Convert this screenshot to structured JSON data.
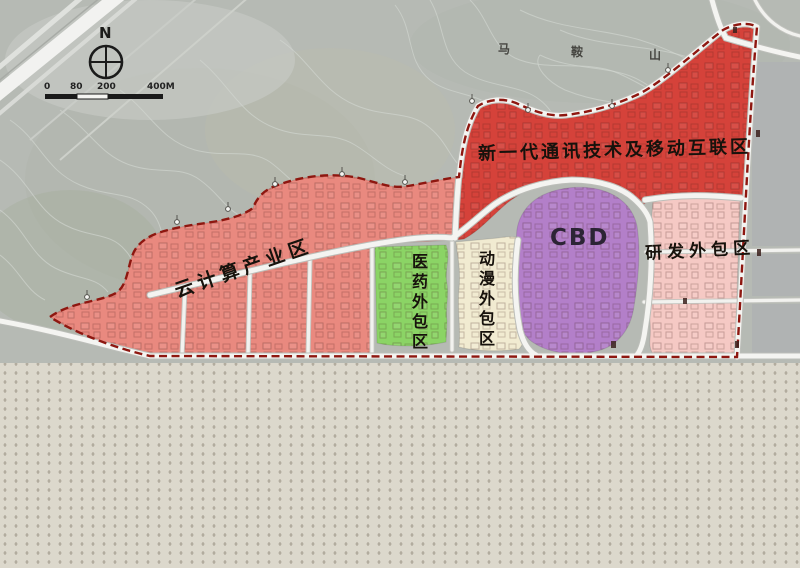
{
  "map": {
    "compass_label": "N",
    "mountain": {
      "char1": "马",
      "char2": "鞍",
      "char3": "山"
    },
    "scale": {
      "t0": "0",
      "t1": "80",
      "t2": "200",
      "t3": "400M"
    },
    "zones": {
      "cloud": {
        "label": "云计算产业区",
        "color": "#e9897f"
      },
      "telecom": {
        "label": "新一代通讯技术及移动互联区",
        "color": "#d5423a"
      },
      "pharma": {
        "label": "医药外包区",
        "color": "#8bd465"
      },
      "anime": {
        "label": "动漫外包区",
        "color": "#f1ebd1"
      },
      "cbd": {
        "label": "CBD",
        "color": "#b37fc9"
      },
      "rnd": {
        "label": "研发外包区",
        "color": "#f5c9c4"
      }
    },
    "boundary_color": "#8e1710",
    "road_color": "#f4f4f1",
    "terrain_color": "#b6bab4",
    "flat_area_color": "#dcd8cc"
  }
}
